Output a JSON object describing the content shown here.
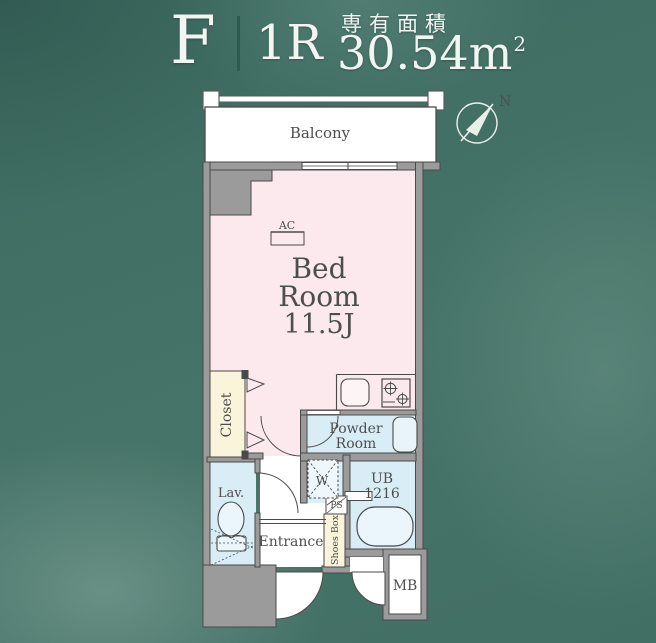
{
  "header": {
    "plan_type": "F",
    "room_layout": "1R",
    "area_caption": "専有面積",
    "area_value": "30.54m",
    "area_superscript": "2"
  },
  "compass": {
    "north": "N"
  },
  "plan": {
    "balcony": "Balcony",
    "bedroom": {
      "line1": "Bed",
      "line2": "Room",
      "size": "11.5J"
    },
    "ac": "AC",
    "closet": "Closet",
    "lavatory": "Lav.",
    "powder_room": {
      "line1": "Powder",
      "line2": "Room"
    },
    "washer": "W",
    "pipe_space": "PS",
    "shoes_box": "Shoes Box",
    "unit_bath": {
      "line1": "UB",
      "line2": "1216"
    },
    "entrance": "Entrance",
    "meter_box": "MB"
  },
  "colors": {
    "background": "#427065",
    "bedroom_fill": "#fbe9ee",
    "wet_area_fill": "#d9edf6",
    "storage_fill": "#faf4da",
    "wall_fill": "#9b9b9b",
    "line": "#4a4a4a",
    "header_text": "#f2f5f2"
  }
}
